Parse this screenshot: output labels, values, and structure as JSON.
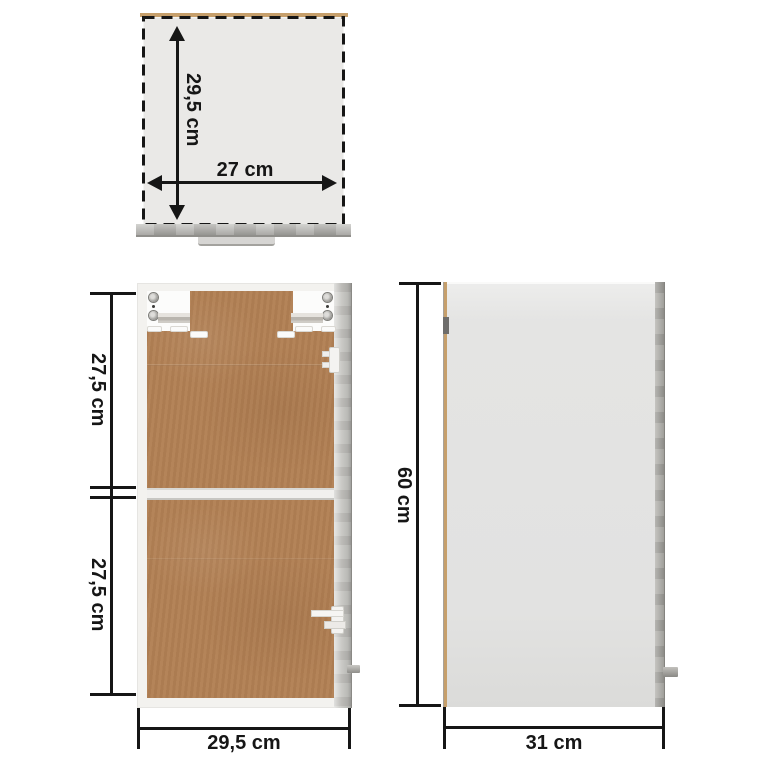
{
  "title": "cabinet-dimension-diagram",
  "views": {
    "top": {
      "depth_label": "29,5 cm",
      "width_label": "27 cm"
    },
    "front": {
      "upper_label": "27,5 cm",
      "lower_label": "27,5 cm",
      "width_label": "29,5 cm"
    },
    "side": {
      "height_label": "60 cm",
      "depth_label": "31 cm"
    }
  },
  "colors": {
    "background": "#ffffff",
    "dimension_lines": "#161616",
    "back_panel_brown": "#b28054",
    "concrete_gray": "#aaa9a4",
    "frame_white": "#f3f2ef",
    "panel_light_gray": "#e3e3e2",
    "wood_edge_tan": "#c69f6b"
  }
}
